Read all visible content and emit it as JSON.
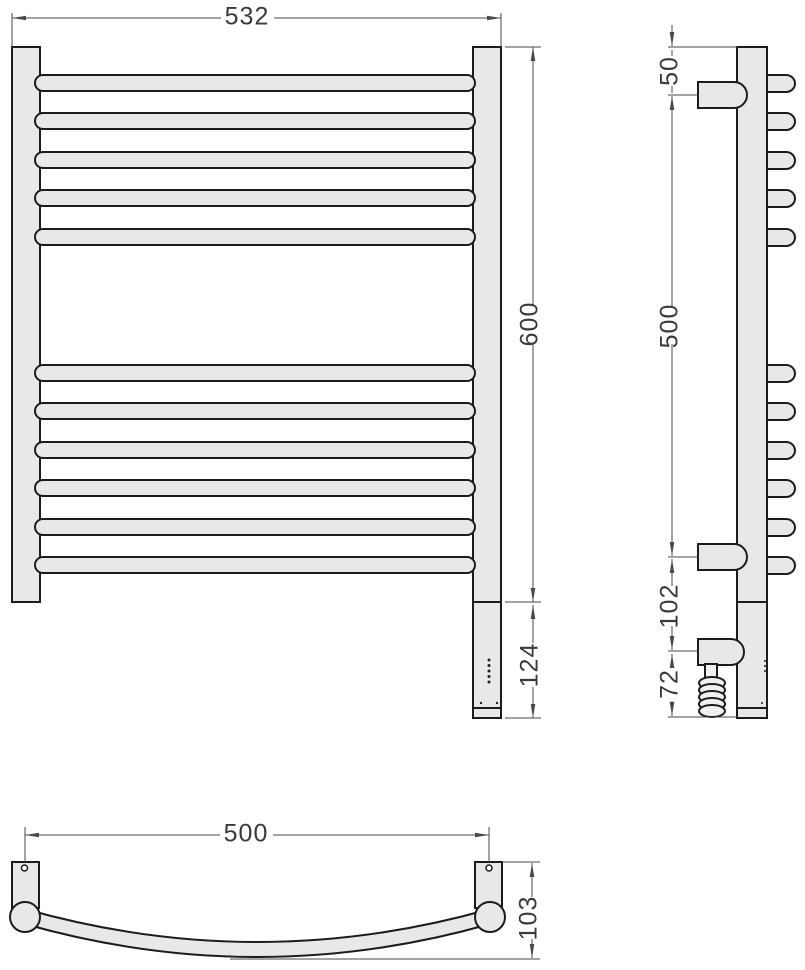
{
  "drawing": {
    "type": "technical-dimension-drawing",
    "subject": "ladder towel rail — front, side and bottom (plan) views",
    "colors": {
      "background": "#ffffff",
      "part_fill": "#e8e8e8",
      "outline": "#1c1c1c",
      "dimension_line": "#4a4a4a",
      "text": "#3a3a3a"
    },
    "front_view": {
      "rung_count": 11,
      "rung_groups": [
        5,
        6
      ],
      "dims": {
        "overall_width": "532",
        "rail_height": "600",
        "heater_section_height": "124"
      }
    },
    "side_view": {
      "bracket_count": 2,
      "dims": {
        "top_to_upper_bracket": "50",
        "bracket_to_bracket": "500",
        "bracket_to_heater": "102",
        "heater_to_bottom": "72"
      }
    },
    "bottom_view": {
      "dims": {
        "mounting_span": "500",
        "depth_from_wall": "103"
      }
    }
  }
}
